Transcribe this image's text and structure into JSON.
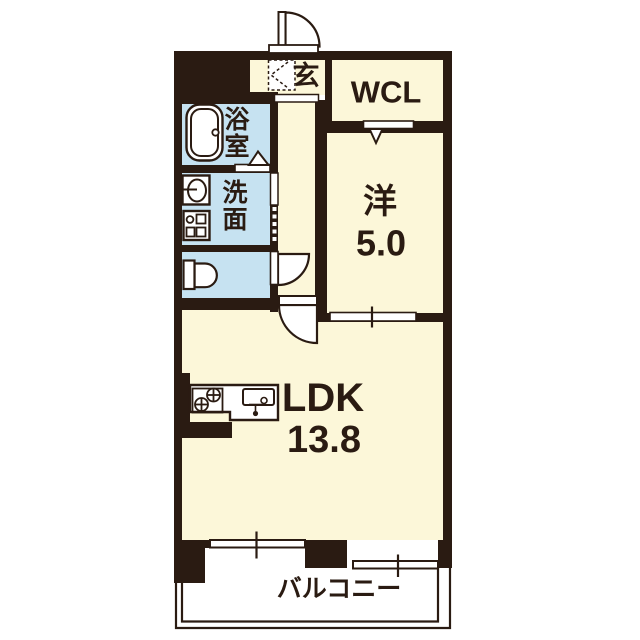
{
  "plan_type": "apartment-floorplan",
  "colors": {
    "wall": "#2a1b12",
    "floor_cream": "#fcf7d9",
    "floor_wet": "#c6e2f1",
    "outside": "#ffffff",
    "line": "#2a1b12"
  },
  "rooms": {
    "genkan": {
      "label": "玄"
    },
    "wcl": {
      "label": "WCL"
    },
    "bathroom": {
      "label": "浴室",
      "chars": [
        "浴",
        "室"
      ]
    },
    "washroom": {
      "label": "洗面",
      "chars": [
        "洗",
        "面"
      ]
    },
    "western_room": {
      "label": "洋",
      "size": "5.0"
    },
    "ldk": {
      "label": "LDK",
      "size": "13.8"
    },
    "balcony": {
      "label": "バルコニー"
    }
  },
  "icons": {
    "bathtub": "bathtub-icon",
    "washbasin": "washbasin-icon",
    "washer_pan": "washing-machine-pan-icon",
    "toilet": "toilet-icon",
    "kitchen": "kitchen-counter-icon",
    "entrance_door": "entrance-door-swing-icon",
    "toilet_door": "toilet-door-swing-icon",
    "ldk_door": "ldk-door-swing-icon",
    "wcl_door": "folding-door-icon",
    "bath_door": "bath-door-triangle-icon",
    "sliding_doors": "sliding-door-icon",
    "windows": "sliding-window-icon"
  }
}
